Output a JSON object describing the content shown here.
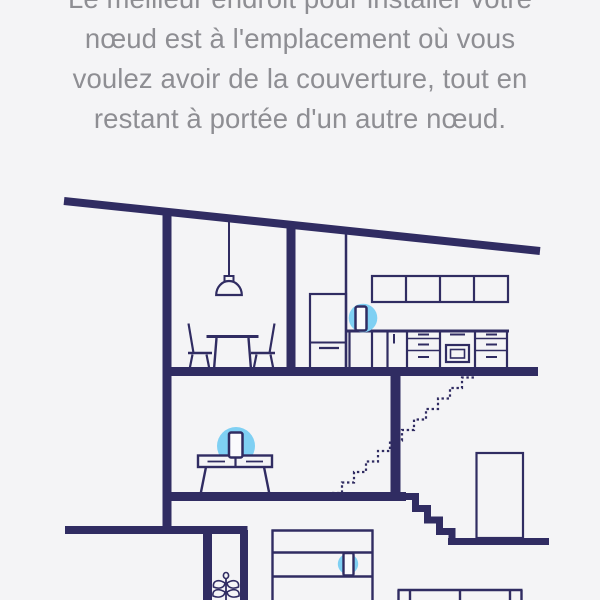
{
  "screen": {
    "name": "node-placement-instruction",
    "instruction": {
      "lines": [
        "Le meilleur endroit pour installer votre",
        "nœud est à l'emplacement où vous",
        "voulez avoir de la couverture, tout en",
        "restant à portée d'un autre nœud."
      ],
      "full_text": "Le meilleur endroit pour installer votre nœud est à l'emplacement où vous voulez avoir de la couverture, tout en restant à portée d'un autre nœud."
    }
  },
  "colors": {
    "background": "#f4f4f6",
    "line_navy": "#302c62",
    "halo_blue": "#7fd0f3",
    "text_gray": "#8e8e93",
    "node_fill": "#fafafc"
  },
  "illustration": {
    "scene": "house-cross-section-line-art",
    "wifi_nodes": [
      {
        "location": "kitchen-counter",
        "halo": true
      },
      {
        "location": "living-room-console",
        "halo": true
      },
      {
        "location": "basement-shelf",
        "halo": true
      }
    ],
    "rooms": [
      "kitchen",
      "dining-area",
      "living-room",
      "stair-landing",
      "basement"
    ]
  }
}
